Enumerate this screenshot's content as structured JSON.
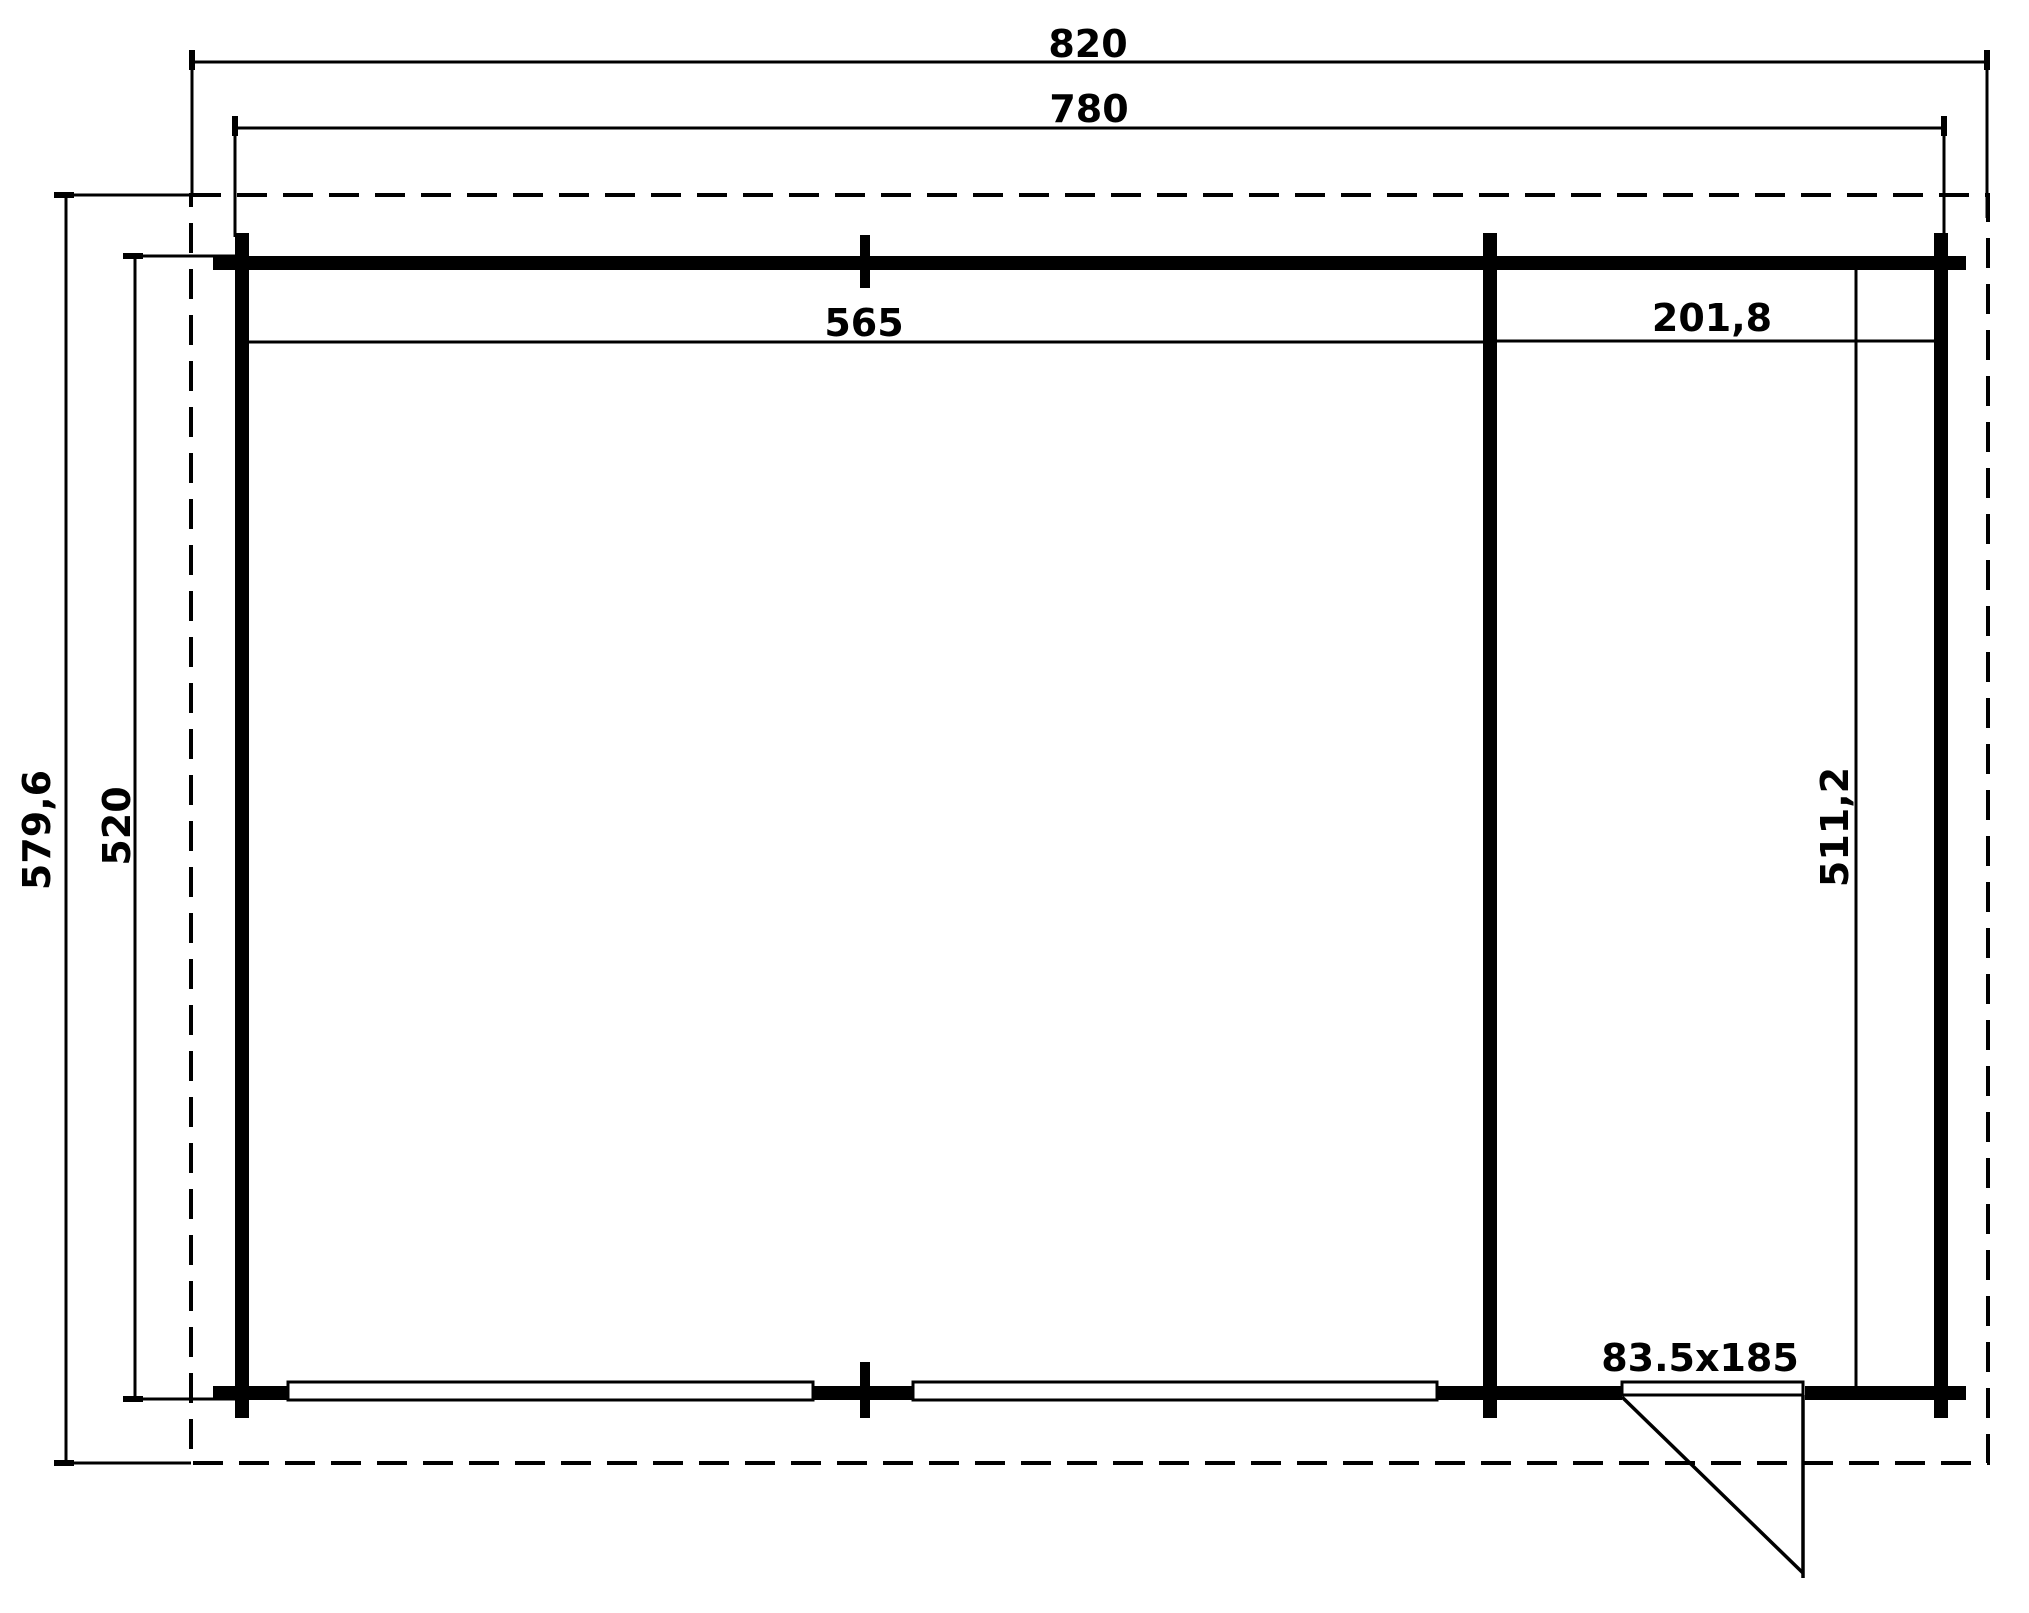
{
  "plan": {
    "dimensions": {
      "overall_width": "820",
      "wall_outer_width": "780",
      "main_room_width": "565",
      "side_room_width": "201,8",
      "overall_depth": "579,6",
      "wall_outer_depth": "520",
      "side_room_depth": "511,2",
      "door_size": "83.5x185"
    },
    "colors": {
      "line": "#000000",
      "background": "#ffffff"
    }
  }
}
